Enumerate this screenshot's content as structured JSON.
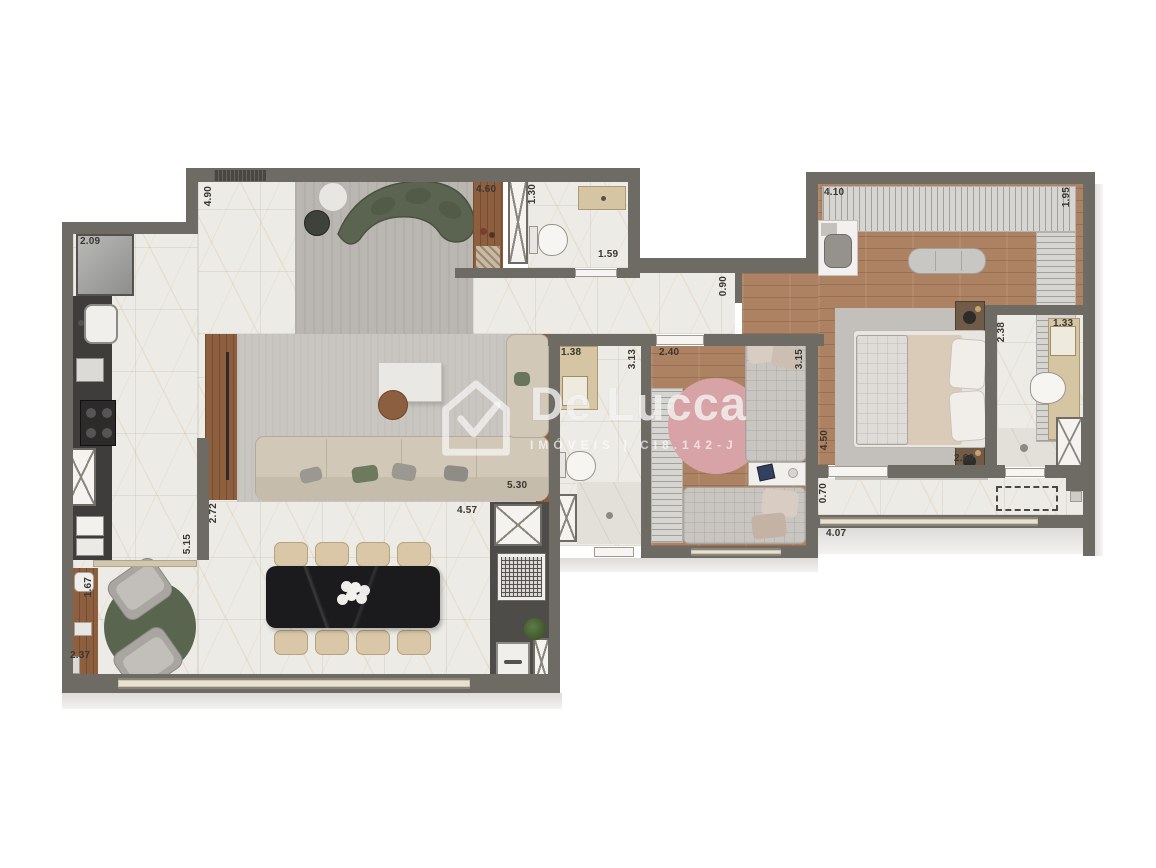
{
  "watermark": {
    "brand": "De Lucca",
    "subtitle": "IMÓVEIS | CI8.142-J",
    "icon": "house-check-icon"
  },
  "dimension_labels": [
    {
      "value": "2.09",
      "x": 80,
      "y": 237,
      "orientation": "horizontal"
    },
    {
      "value": "4.90",
      "x": 204,
      "y": 186,
      "orientation": "vertical"
    },
    {
      "value": "4.60",
      "x": 476,
      "y": 185,
      "orientation": "horizontal"
    },
    {
      "value": "1.30",
      "x": 528,
      "y": 184,
      "orientation": "vertical"
    },
    {
      "value": "1.59",
      "x": 598,
      "y": 250,
      "orientation": "horizontal"
    },
    {
      "value": "4.10",
      "x": 824,
      "y": 188,
      "orientation": "horizontal"
    },
    {
      "value": "1.95",
      "x": 1062,
      "y": 187,
      "orientation": "vertical"
    },
    {
      "value": "0.90",
      "x": 719,
      "y": 276,
      "orientation": "vertical"
    },
    {
      "value": "1.38",
      "x": 561,
      "y": 348,
      "orientation": "horizontal"
    },
    {
      "value": "3.13",
      "x": 628,
      "y": 349,
      "orientation": "vertical"
    },
    {
      "value": "2.40",
      "x": 659,
      "y": 348,
      "orientation": "horizontal"
    },
    {
      "value": "3.15",
      "x": 795,
      "y": 349,
      "orientation": "vertical"
    },
    {
      "value": "2.38",
      "x": 997,
      "y": 322,
      "orientation": "vertical"
    },
    {
      "value": "1.33",
      "x": 1053,
      "y": 319,
      "orientation": "horizontal"
    },
    {
      "value": "4.50",
      "x": 820,
      "y": 430,
      "orientation": "vertical"
    },
    {
      "value": "2.60",
      "x": 954,
      "y": 454,
      "orientation": "horizontal"
    },
    {
      "value": "0.70",
      "x": 819,
      "y": 483,
      "orientation": "vertical"
    },
    {
      "value": "4.07",
      "x": 826,
      "y": 529,
      "orientation": "horizontal"
    },
    {
      "value": "5.30",
      "x": 507,
      "y": 481,
      "orientation": "horizontal"
    },
    {
      "value": "4.57",
      "x": 457,
      "y": 506,
      "orientation": "horizontal"
    },
    {
      "value": "2.72",
      "x": 209,
      "y": 503,
      "orientation": "vertical"
    },
    {
      "value": "5.15",
      "x": 183,
      "y": 534,
      "orientation": "vertical"
    },
    {
      "value": "1.67",
      "x": 84,
      "y": 577,
      "orientation": "vertical"
    },
    {
      "value": "2.37",
      "x": 70,
      "y": 651,
      "orientation": "horizontal"
    }
  ],
  "palette": {
    "wall": "#6e6a64",
    "marble_floor": "#edebe6",
    "wood_floor": "#ac8263",
    "concrete_floor": "#bab7b2",
    "living_rug": "#c9c6c1",
    "sofa_green": "#5b6450",
    "rug_green": "#59654e",
    "rug_pink": "#d8a3a6",
    "dining_table": "#1b1b1e",
    "kitchen_counter": "#3f3d3b",
    "vanity_beige": "#d5c5a2"
  }
}
